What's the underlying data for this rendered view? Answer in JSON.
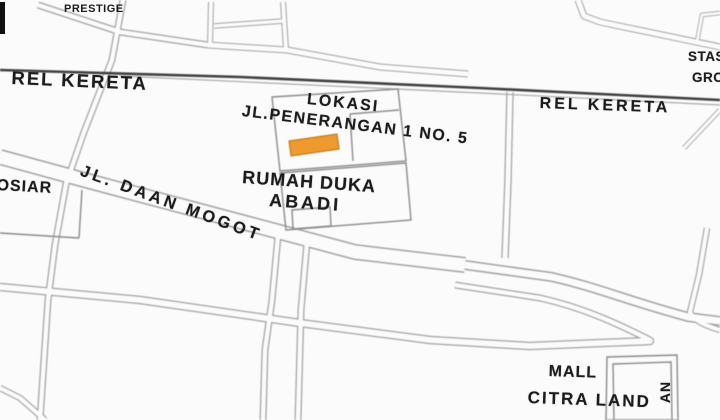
{
  "labels": {
    "prestige": "PRESTIGE",
    "rail_left": "REL KERETA",
    "rail_right": "REL KERETA",
    "station_line1": "STAS",
    "station_line2": "GRO",
    "lokasi": "LOKASI",
    "street": "JL.PENERANGAN 1 NO. 5",
    "rumah_duka": "RUMAH DUKA",
    "abadi": "ABADI",
    "daan_mogot": "JL. DAAN MOGOT",
    "osiar": "OSIAR",
    "mall": "MALL",
    "citra_land": "CITRA LAND",
    "side_street_vertical": "AN"
  },
  "colors": {
    "highlight": "#EE9A2F",
    "road_outline": "#A2A2A2",
    "railway": "#3F3F3F",
    "text": "#1C1C1C",
    "background": "#FCFBFB",
    "edge_marker": "#111111"
  }
}
